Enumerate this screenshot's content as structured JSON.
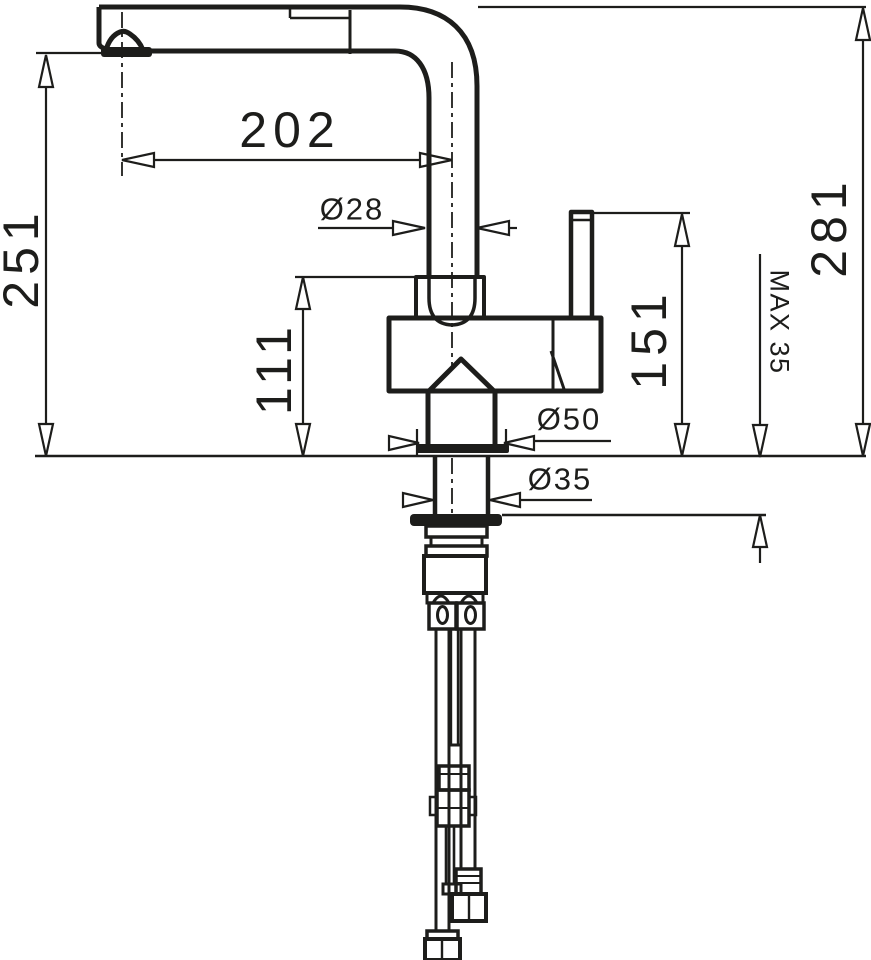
{
  "drawing": {
    "labels": {
      "spout_reach": "202",
      "spout_diameter": "Ø28",
      "outlet_height": "251",
      "body_height": "111",
      "handle_height": "151",
      "total_height": "281",
      "max_counter_thickness": "MAX 35",
      "base_diameter": "Ø50",
      "shank_diameter": "Ø35"
    },
    "colors": {
      "line": "#1d1d1b",
      "background": "#ffffff"
    }
  }
}
